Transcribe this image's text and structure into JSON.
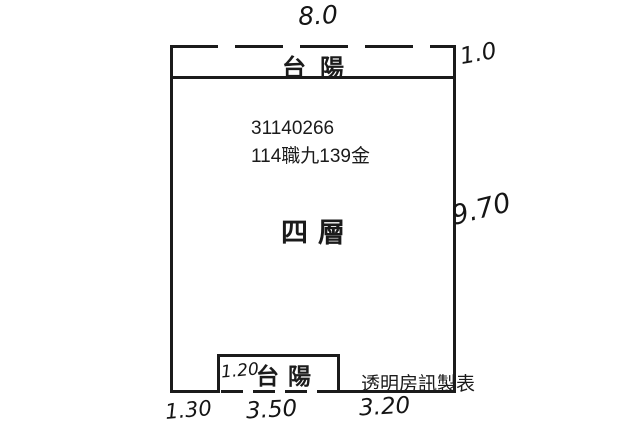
{
  "title": "四層 floor plan sketch",
  "colors": {
    "ink": "#1b1b1b",
    "paper": "#ffffff"
  },
  "dimensions": {
    "top_width": "8.0",
    "top_balcony_depth": "1.0",
    "right_height": "9.70",
    "bottom_left": "1.30",
    "bottom_balcony_width": "3.50",
    "bottom_right": "3.20",
    "bottom_balcony_depth": "1.20"
  },
  "labels": {
    "top_balcony": "台陽",
    "bottom_balcony": "台陽",
    "floor": "四層",
    "unit_number": "31140266",
    "unit_code": "114職九139金",
    "credit": "透明房訊製表"
  }
}
